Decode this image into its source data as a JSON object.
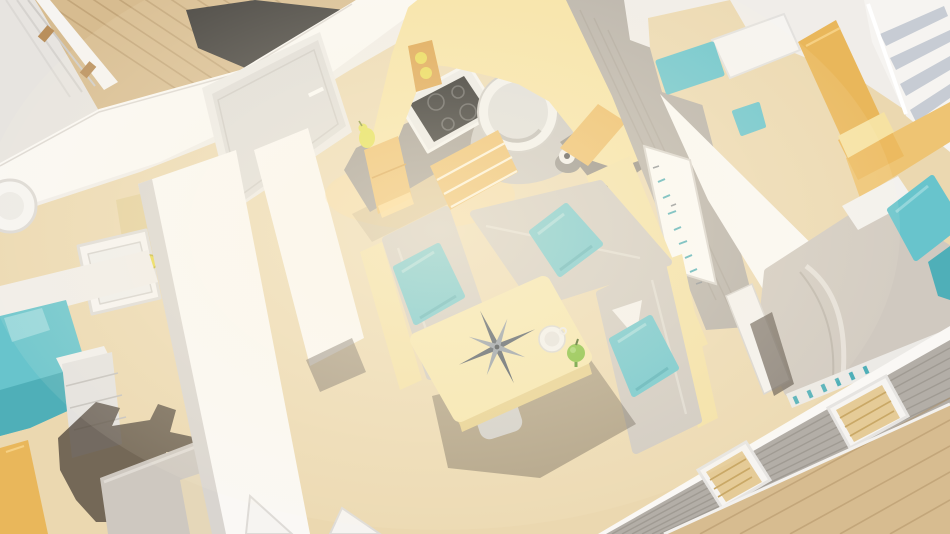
{
  "meta": {
    "type": "3d-architectural-render",
    "subject": "Aerial cutaway view of a small mobile-home interior",
    "view": "top-down oblique, walls cut away, no visible text"
  },
  "palette": {
    "wall": "#f0ede9",
    "wallBright": "#faf8f5",
    "wallShade": "#d9d5d0",
    "wallDim": "#e7e4e0",
    "floorWood": "#ebd8b0",
    "floorSeam": "#b3placeholder",
    "deckWood": "#d7bc90",
    "deckSeam": "#ab8c60",
    "doormat": "#3e3c39",
    "railWhite": "#f6f4f1",
    "cabinetTop": "#f6e2a2",
    "cabinetFront": "#ecba60",
    "cabinetDeep": "#db9f45",
    "counter": "#9a948d",
    "counterLight": "#c7c4c0",
    "counterDark": "#8b867f",
    "cooktop": "#191919",
    "steel": "#e9e9e8",
    "sinkBowl": "#dcdcdb",
    "teal": "#68c4cc",
    "tealDark": "#4fafb8",
    "tealLight": "#93d6db",
    "cushion": "#cec8c0",
    "cushionLight": "#dfdad3",
    "benchWood": "#f3e0a4",
    "tableTop": "#f5e5ab",
    "tableSide": "#e6cf8c",
    "compass": "#46505c",
    "compassLight": "#8b95a1",
    "apple": "#7cbc33",
    "appleDark": "#4e8f1f",
    "artWall": "#b5afa7",
    "artPanel": "#fbfaf8",
    "duvet": "#d0c9c0",
    "sheet": "#f3f1ee",
    "siding": "#b3aea7",
    "blinds": "#e5cb97",
    "shelf": "#c7ccd4",
    "shadow": "#564c41",
    "glow": "#ffd98d",
    "jar": "#e8d84c",
    "pear": "#e2df48",
    "doorYellow": "#e9b75b",
    "doorLeaf": "#dedcd9"
  },
  "scene": {
    "rooms": [
      {
        "id": "living-dining",
        "label": "open-plan living and dining area"
      },
      {
        "id": "kitchen",
        "label": "L-shaped kitchen"
      },
      {
        "id": "master-bedroom",
        "label": "bedroom with double bed"
      },
      {
        "id": "kids-bedroom",
        "label": "second bedroom with teal beds"
      },
      {
        "id": "bathroom",
        "label": "bathroom with shower tray"
      },
      {
        "id": "hallway",
        "label": "hallway with bath mats"
      },
      {
        "id": "deck",
        "label": "outdoor timber deck with cable railing"
      }
    ],
    "objects": [
      {
        "id": "dining-table",
        "label": "yellow table with compass-rose print, coffee cup and green apple"
      },
      {
        "id": "corner-bench",
        "label": "U-shaped grey bench seating with three teal cushions"
      },
      {
        "id": "kitchen-counter",
        "label": "grey worktop with induction hob, round sink and tap"
      },
      {
        "id": "wall-art",
        "label": "white wall panel with small teal bird motifs"
      },
      {
        "id": "double-bed",
        "label": "bed with grey duvet and teal pillows"
      },
      {
        "id": "wardrobe-shelves",
        "label": "open white shelving unit"
      },
      {
        "id": "front-door",
        "label": "grey entrance door with dark doormat outside"
      },
      {
        "id": "windows",
        "label": "exterior window row with venetian blinds and grey cladding"
      }
    ]
  }
}
